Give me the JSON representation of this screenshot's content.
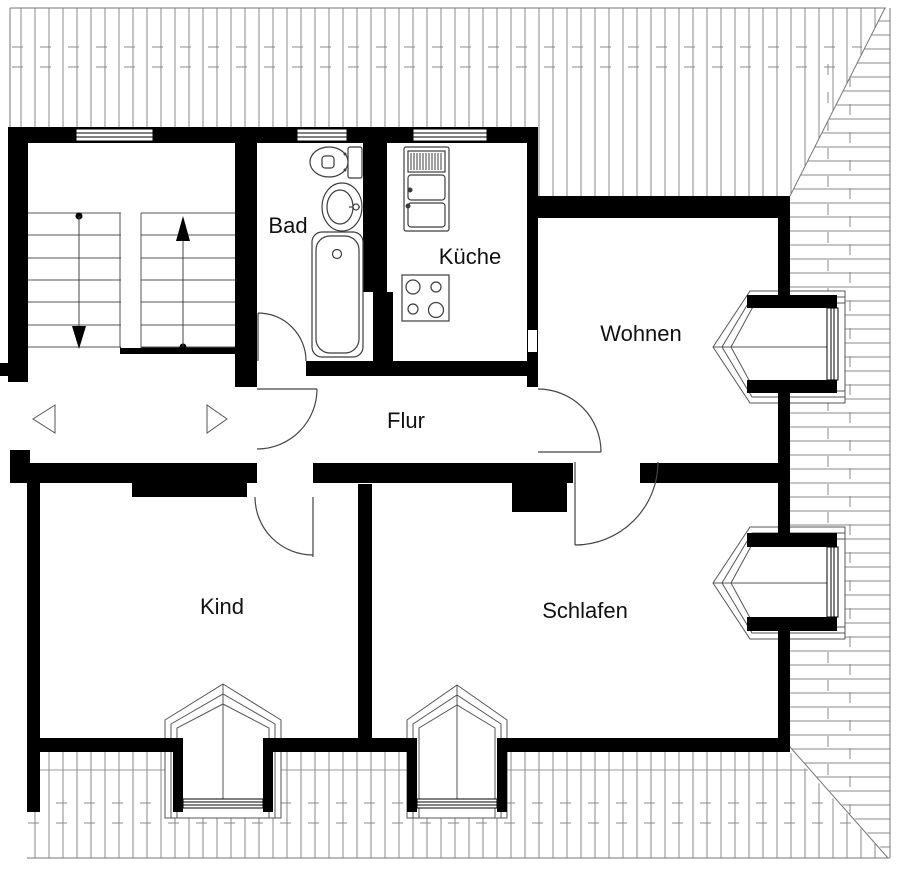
{
  "plan": {
    "rooms": [
      {
        "id": "bad",
        "label": "Bad"
      },
      {
        "id": "kueche",
        "label": "Küche"
      },
      {
        "id": "wohnen",
        "label": "Wohnen"
      },
      {
        "id": "flur",
        "label": "Flur"
      },
      {
        "id": "kind",
        "label": "Kind"
      },
      {
        "id": "schlafen",
        "label": "Schlafen"
      }
    ],
    "stair": {
      "flights": 2,
      "treads_per_flight": 6,
      "up_marker_icon": "up-arrow-icon",
      "down_marker_icon": "down-arrow-icon"
    },
    "fixtures": [
      {
        "icon": "toilet-icon",
        "room": "Bad"
      },
      {
        "icon": "washbasin-icon",
        "room": "Bad"
      },
      {
        "icon": "bathtub-icon",
        "room": "Bad"
      },
      {
        "icon": "kitchen-sink-icon",
        "room": "Küche"
      },
      {
        "icon": "stove-icon",
        "room": "Küche"
      }
    ],
    "openings": {
      "facade_windows": 3,
      "dormer_windows": 4,
      "doors": 5,
      "corridor_direction_markers": 2
    },
    "colors": {
      "walls": "#000000",
      "hatch_lines": "#8a8a8a",
      "thin_lines": "#555555",
      "fixture_lines": "#3c3c3c",
      "background": "#ffffff",
      "text": "#111111"
    }
  }
}
